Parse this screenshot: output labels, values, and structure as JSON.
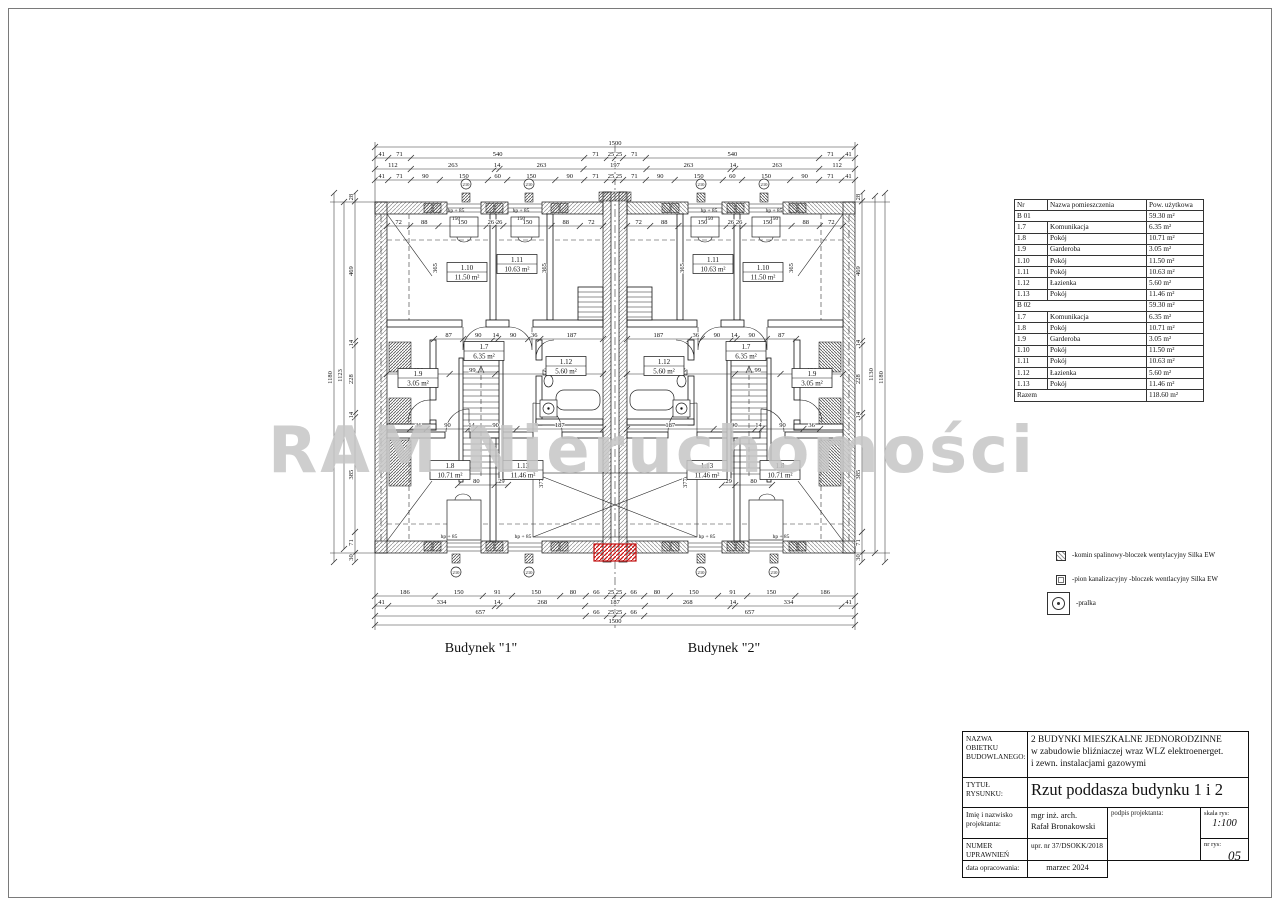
{
  "watermark": "RAM Nieruchomości",
  "plan": {
    "building1_label": "Budynek \"1\"",
    "building2_label": "Budynek \"2\"",
    "marker_circle": "210",
    "hp_label": "hp + 85",
    "win_width_label": "150",
    "dims": {
      "top_row1": [
        "1500"
      ],
      "top_row2": [
        "41",
        "71",
        "540",
        "71",
        "25",
        "25",
        "71",
        "540",
        "71",
        "41"
      ],
      "top_row3": [
        "112",
        "263",
        "14",
        "263",
        "197",
        "263",
        "14",
        "263",
        "112"
      ],
      "top_row4": [
        "41",
        "71",
        "90",
        "150",
        "60",
        "150",
        "90",
        "71",
        "25",
        "25",
        "71",
        "90",
        "150",
        "60",
        "150",
        "90",
        "71",
        "41"
      ],
      "bottom_row1": [
        "186",
        "150",
        "91",
        "150",
        "80",
        "66",
        "25",
        "25",
        "66",
        "80",
        "150",
        "91",
        "150",
        "186"
      ],
      "bottom_row2": [
        "41",
        "334",
        "14",
        "268",
        "187",
        "268",
        "14",
        "334",
        "41"
      ],
      "bottom_row3": [
        "657",
        "66",
        "25",
        "25",
        "66",
        "657"
      ],
      "bottom_row4": [
        "1500"
      ],
      "left_col": [
        "28",
        "469",
        "14",
        "228",
        "14",
        "385",
        "71",
        "30"
      ],
      "left_total_inner": [
        "1123"
      ],
      "left_total_outer": [
        "1180"
      ],
      "right_col": [
        "28",
        "469",
        "14",
        "228",
        "14",
        "385",
        "71",
        "30"
      ],
      "right_total_inner": [
        "1130"
      ],
      "right_total_outer": [
        "1180"
      ],
      "b1_top": [
        "72",
        "88",
        "150",
        "26",
        "26",
        "150",
        "88",
        "72"
      ],
      "b1_mid": [
        "136",
        "99",
        "234"
      ],
      "b1_corr": [
        "87",
        "90",
        "14",
        "90",
        "36",
        "187"
      ],
      "b1_low": [
        "36",
        "90",
        "14",
        "90",
        "187"
      ],
      "b1_small": [
        "80",
        "29"
      ],
      "b1_vert": [
        "365",
        "365",
        "377"
      ],
      "b2_top": [
        "72",
        "88",
        "150",
        "26",
        "26",
        "150",
        "88",
        "72"
      ],
      "b2_mid": [
        "235",
        "99",
        "136"
      ],
      "b2_corr": [
        "187",
        "36",
        "90",
        "14",
        "90",
        "87"
      ],
      "b2_low": [
        "187",
        "90",
        "14",
        "90",
        "36"
      ],
      "b2_small": [
        "29",
        "80"
      ],
      "b2_vert": [
        "365",
        "365",
        "377"
      ]
    },
    "rooms_b1": [
      {
        "no": "1.10",
        "area": "11.50 m²"
      },
      {
        "no": "1.11",
        "area": "10.63 m²"
      },
      {
        "no": "1.7",
        "area": "6.35 m²"
      },
      {
        "no": "1.12",
        "area": "5.60 m²"
      },
      {
        "no": "1.9",
        "area": "3.05 m²"
      },
      {
        "no": "1.8",
        "area": "10.71 m²"
      },
      {
        "no": "1.13",
        "area": "11.46 m²"
      }
    ],
    "rooms_b2": [
      {
        "no": "1.11",
        "area": "10.63 m²"
      },
      {
        "no": "1.10",
        "area": "11.50 m²"
      },
      {
        "no": "1.7",
        "area": "6.35 m²"
      },
      {
        "no": "1.12",
        "area": "5.60 m²"
      },
      {
        "no": "1.9",
        "area": "3.05 m²"
      },
      {
        "no": "1.13",
        "area": "11.46 m²"
      },
      {
        "no": "1.8",
        "area": "10.71 m²"
      }
    ]
  },
  "room_table": {
    "headers": [
      "Nr",
      "Nazwa pomieszczenia",
      "Pow. użytkowa"
    ],
    "rows": [
      {
        "nr": "B 01",
        "name": "",
        "area": "59.30 m²",
        "group": true
      },
      {
        "nr": "1.7",
        "name": "Komunikacja",
        "area": "6.35 m²"
      },
      {
        "nr": "1.8",
        "name": "Pokój",
        "area": "10.71 m²"
      },
      {
        "nr": "1.9",
        "name": "Garderoba",
        "area": "3.05 m²"
      },
      {
        "nr": "1.10",
        "name": "Pokój",
        "area": "11.50 m²"
      },
      {
        "nr": "1.11",
        "name": "Pokój",
        "area": "10.63 m²"
      },
      {
        "nr": "1.12",
        "name": "Łazienka",
        "area": "5.60 m²"
      },
      {
        "nr": "1.13",
        "name": "Pokój",
        "area": "11.46 m²"
      },
      {
        "nr": "B 02",
        "name": "",
        "area": "59.30 m²",
        "group": true
      },
      {
        "nr": "1.7",
        "name": "Komunikacja",
        "area": "6.35 m²"
      },
      {
        "nr": "1.8",
        "name": "Pokój",
        "area": "10.71 m²"
      },
      {
        "nr": "1.9",
        "name": "Garderoba",
        "area": "3.05 m²"
      },
      {
        "nr": "1.10",
        "name": "Pokój",
        "area": "11.50 m²"
      },
      {
        "nr": "1.11",
        "name": "Pokój",
        "area": "10.63 m²"
      },
      {
        "nr": "1.12",
        "name": "Łazienka",
        "area": "5.60 m²"
      },
      {
        "nr": "1.13",
        "name": "Pokój",
        "area": "11.46 m²"
      },
      {
        "nr": "Razem",
        "name": "",
        "area": "118.60 m²",
        "group": true
      }
    ]
  },
  "legend": {
    "items": [
      {
        "icon": "komin-icon",
        "label": "-komin spalinowy-bloczek wentylacyjny Silka EW"
      },
      {
        "icon": "pion-icon",
        "label": "-pion kanalizacyjny -bloczek wentlacyjny Silka EW"
      },
      {
        "icon": "pralka-icon",
        "label": "-pralka"
      }
    ]
  },
  "title_block": {
    "name_label": "NAZWA OBIETKU\nBUDOWLANEGO:",
    "name_value": "2 BUDYNKI MIESZKALNE JEDNORODZINNE\nw zabudowie bliźniaczej wraz WLZ elektroenerget.\ni zewn. instalacjami gazowymi",
    "title_label": "TYTUŁ\nRYSUNKU:",
    "title_value": "Rzut poddasza budynku 1 i 2",
    "designer_label": "Imię i nazwisko\nprojektanta:",
    "designer_value": "mgr inż. arch.\nRafał Bronakowski",
    "signature_label": "podpis projektanta:",
    "scale_label": "skala rys:",
    "scale_value": "1:100",
    "permit_label": "NUMER UPRAWNIEŃ\nBUDOWLANYCH:",
    "permit_value": "upr. nr 37/DSOKK/2018",
    "sheet_label": "nr rys:",
    "sheet_value": "05",
    "date_label": "data opracowania:",
    "date_value": "marzec 2024"
  }
}
